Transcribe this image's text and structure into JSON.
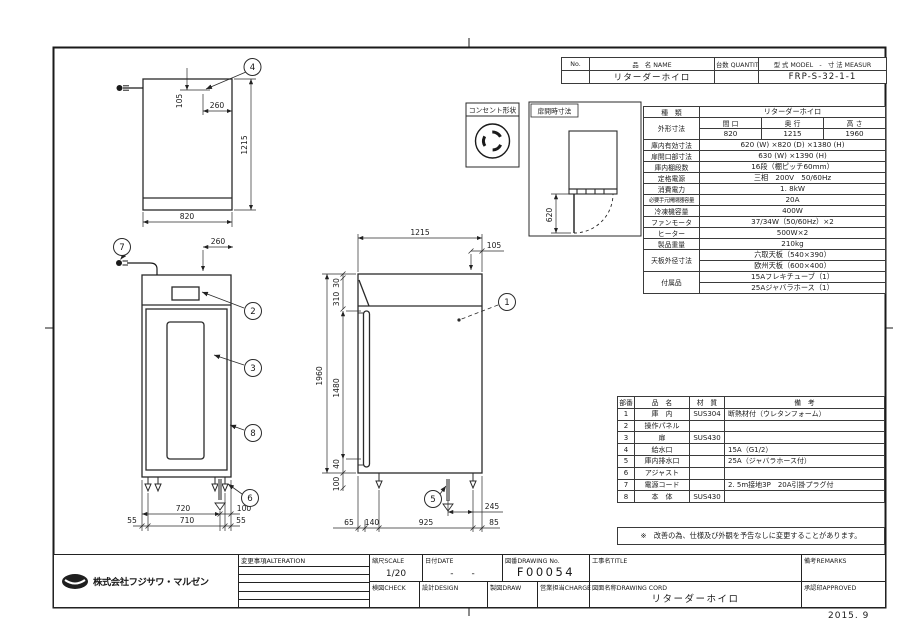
{
  "frame": {
    "footer_date": "2015. 9"
  },
  "model_table": {
    "no_label": "No.",
    "name_label": "品　名 NAME",
    "qty_label": "台数 QUANTITY",
    "model_label": "型 式 MODEL　-　寸 法 MEASUR",
    "name_value": "リターダーホイロ",
    "model_value": "FRP-S-32-1-1"
  },
  "spec_table": {
    "kind_label": "種　類",
    "kind_value": "リターダーホイロ",
    "outer_label": "外形寸法",
    "w_label": "間 口",
    "d_label": "奥 行",
    "h_label": "高 さ",
    "w_value": "820",
    "d_value": "1215",
    "h_value": "1960",
    "rows": [
      {
        "label": "庫内有効寸法",
        "value": "620 (W) ×820 (D) ×1380 (H)"
      },
      {
        "label": "扉開口部寸法",
        "value": "630 (W) ×1390 (H)"
      },
      {
        "label": "庫内棚段数",
        "value": "16段（棚ピッチ60mm）"
      },
      {
        "label": "定格電源",
        "value": "三相　200V　50/60Hz"
      },
      {
        "label": "消費電力",
        "value": "1. 8kW"
      },
      {
        "label": "必要手元開閉器容量",
        "value": "20A"
      },
      {
        "label": "冷凍機容量",
        "value": "400W"
      },
      {
        "label": "ファンモータ",
        "value": "37/34W（50/60Hz）×2"
      },
      {
        "label": "ヒーター",
        "value": "500W×2"
      },
      {
        "label": "製品重量",
        "value": "210kg"
      }
    ],
    "top_plate_label": "天板外径寸法",
    "top_plate_value1": "六取天板（540×390）",
    "top_plate_value2": "欧州天板（600×400）",
    "accessory_label": "付属品",
    "accessory_value1": "15Aフレキチューブ（1）",
    "accessory_value2": "25Aジャバラホース（1）"
  },
  "outlet_box": {
    "title": "コンセント形状"
  },
  "door_open_box": {
    "title": "扉開時寸法"
  },
  "parts_table": {
    "no_label": "部番",
    "name_label": "品　名",
    "material_label": "材　質",
    "remark_label": "備　考",
    "rows": [
      {
        "no": "1",
        "name": "庫　内",
        "material": "SUS304",
        "remark": "断熱材付（ウレタンフォーム）"
      },
      {
        "no": "2",
        "name": "操作パネル",
        "material": "",
        "remark": ""
      },
      {
        "no": "3",
        "name": "扉",
        "material": "SUS430",
        "remark": ""
      },
      {
        "no": "4",
        "name": "給水口",
        "material": "",
        "remark": "15A（G1/2）"
      },
      {
        "no": "5",
        "name": "庫内排水口",
        "material": "",
        "remark": "25A（ジャバラホース付）"
      },
      {
        "no": "6",
        "name": "アジャスト",
        "material": "",
        "remark": ""
      },
      {
        "no": "7",
        "name": "電源コード",
        "material": "",
        "remark": "2. 5m接地3P　20A引掛プラグ付"
      },
      {
        "no": "8",
        "name": "本　体",
        "material": "SUS430",
        "remark": ""
      }
    ]
  },
  "note": "※　改善の為、仕様及び外観を予告なしに変更することがあります。",
  "title_block": {
    "company": "株式会社フジサワ・マルゼン",
    "alteration_label": "変更事項ALTERATION",
    "scale_label": "縮尺SCALE",
    "scale_value": "1/20",
    "date_label": "日付DATE",
    "date_value": "-　　-",
    "drawing_no_label": "図番DRAWING No.",
    "drawing_no_value": "F00054",
    "title_label": "工事名TITLE",
    "remarks_label": "備考REMARKS",
    "check_label": "検図CHECK",
    "design_label": "設計DESIGN",
    "draw_label": "製図DRAW",
    "charge_label": "営業担当CHARGE",
    "drawing_name_label": "図面名称DRAWING CORD",
    "drawing_name_value": "リターダーホイロ",
    "approved_label": "承認印APPROVED"
  },
  "callouts": {
    "c1": "1",
    "c2": "2",
    "c3": "3",
    "c4": "4",
    "c5": "5",
    "c6": "6",
    "c7": "7",
    "c8": "8"
  },
  "dims": {
    "plan": {
      "d105": "105",
      "d260": "260",
      "d1215": "1215",
      "d820": "820"
    },
    "front": {
      "d260": "260",
      "d720": "720",
      "d100": "100",
      "d55_left": "55",
      "d710": "710",
      "d55_right": "55"
    },
    "side": {
      "d1215": "1215",
      "d105": "105",
      "d30": "30",
      "d310": "310",
      "d1960": "1960",
      "d1480": "1480",
      "d40": "40",
      "d100": "100",
      "d65": "65",
      "d140": "140",
      "d925": "925",
      "d245": "245",
      "d85": "85"
    },
    "door_open": {
      "d620": "620"
    }
  }
}
